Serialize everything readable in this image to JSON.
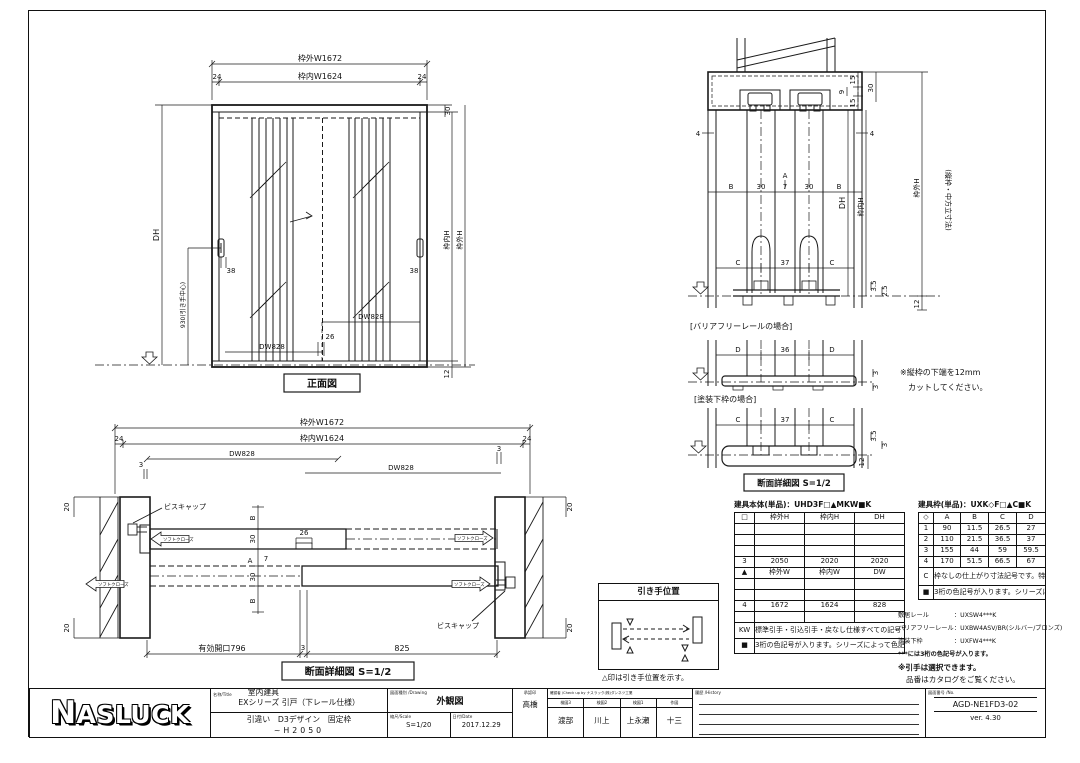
{
  "front_view": {
    "caption": "正面図",
    "w_out": "枠外W1672",
    "w_in": "枠内W1624",
    "m24l": "24",
    "m24r": "24",
    "m30": "30",
    "dh": "DH",
    "handle_center": "930(引き手中心)",
    "m38l": "38",
    "m38r": "38",
    "dw_l": "DW828",
    "dw_r": "DW828",
    "m26": "26",
    "h_in": "枠内H",
    "h_out": "枠外H",
    "m12": "12"
  },
  "plan_section": {
    "caption": "断面詳細図 S=1/2",
    "w_out": "枠外W1672",
    "w_in": "枠内W1624",
    "m24l": "24",
    "m24r": "24",
    "dw_l": "DW828",
    "dw_r": "DW828",
    "m3l": "3",
    "m3r": "3",
    "m20": "20",
    "screw_cap": "ビスキャップ",
    "soft_close": "ソフトクローズ",
    "mB": "B",
    "m30": "30",
    "m26": "26",
    "mA": "A",
    "m7": "7",
    "opening": "有効開口796",
    "m3c": "3",
    "m825": "825"
  },
  "vertical_section": {
    "m4l": "4",
    "m4r": "4",
    "mB1": "B",
    "m30a": "30",
    "m7": "7",
    "m30b": "30",
    "mB2": "B",
    "mA": "A",
    "m15a": "15",
    "m9": "9",
    "m15b": "15",
    "m30r": "30",
    "dh": "DH",
    "h_in": "枠内H",
    "h_out": "枠外H",
    "m12": "12",
    "v_note": "(縦枠・中方立寸法)",
    "rail1": {
      "c1": "C",
      "m37": "37",
      "c2": "C",
      "m35": "3.5",
      "m25": "2.5",
      "label": "[バリアフリーレールの場合]"
    },
    "rail2": {
      "d1": "D",
      "m36": "36",
      "d2": "D",
      "m3a": "3",
      "m3b": "3",
      "label": "[塗装下枠の場合]"
    },
    "rail3": {
      "c1": "C",
      "m37": "37",
      "c2": "C",
      "m35": "3.5",
      "m3": "3",
      "m12": "12",
      "caption": "断面詳細図 S=1/2"
    },
    "cut_note1": "※縦枠の下端を12mm",
    "cut_note2": "カットしてください。"
  },
  "handle_box": {
    "title": "引き手位置",
    "note": "△印は引き手位置を示す。"
  },
  "body_table": {
    "title": "建具本体(単品)：UHD3F□▲MKW■K",
    "h1": [
      "□",
      "枠外H",
      "枠内H",
      "DH"
    ],
    "row3": [
      "3",
      "2050",
      "2020",
      "2020"
    ],
    "h2": [
      "▲",
      "枠外W",
      "枠内W",
      "DW"
    ],
    "row4": [
      "4",
      "1672",
      "1624",
      "828"
    ],
    "kw_label": "KW",
    "kw_note": "標準引手・引込引手・戻なし仕様すべての記号です。特あり仕様設定はありません。引手Noによって記号は異なります。",
    "sq_label": "■",
    "sq_note": "3桁の色記号が入ります。シリーズによって色記号が設定されています。"
  },
  "frame_table": {
    "title": "建具枠(単品)：UXK◇F□▲C■K",
    "header": [
      "◇",
      "A",
      "B",
      "C",
      "D"
    ],
    "rows": [
      [
        "1",
        "90",
        "11.5",
        "26.5",
        "27"
      ],
      [
        "2",
        "110",
        "21.5",
        "36.5",
        "37"
      ],
      [
        "3",
        "155",
        "44",
        "59",
        "59.5"
      ],
      [
        "4",
        "170",
        "51.5",
        "66.5",
        "67"
      ]
    ],
    "c_label": "C",
    "c_note": "枠なしの仕上がり寸法記号です。特あり仕様設定はありません。敷居レール・バリアフリーレール・塗装下枠は選択されません。",
    "sq_label": "■",
    "sq_note": "3桁の色記号が入ります。シリーズによって色記号が設定されています。"
  },
  "rail_notes": {
    "sill_label": "敷居レール",
    "sill_value": "：UXSW4***K",
    "bf_label": "バリアフリーレール",
    "bf_value": "：UXBW4ASV/BR(シルバー/ブロンズ)",
    "paint_label": "塗装下枠",
    "paint_value": "：UXFW4***K",
    "color_note": "***には3桁の色記号が入ります。",
    "select_note": "※引手は選択できます。",
    "catalog_note": "品番はカタログをご覧ください。"
  },
  "title_block": {
    "logo": "NASLUCK",
    "name_header": "名称/Title",
    "name1": "室内建具",
    "name2": "EXシリーズ 引戸（下レール仕様）",
    "name3": "引違い　D3デザイン　固定枠",
    "name4": "~H2050",
    "drawing_header": "図面種別 /Drawing",
    "drawing_value": "外観図",
    "scale_header": "縮尺/Scale",
    "scale_value": "S=1/20",
    "date_header": "日付/Date",
    "date_value": "2017.12.29",
    "approval_header": "承認印",
    "approval_value": "高橋",
    "check_header": "確認者 /Check up by ナスラック(株)ダンネツ工業",
    "col1_header": "検図3",
    "col1_value": "渡部",
    "col2_header": "検図2",
    "col2_value": "川上",
    "col3_header": "検図1",
    "col3_value": "上永瀬",
    "col4_header": "作図",
    "col4_value": "十三",
    "history_header": "履歴 /History",
    "number_header": "図面番号 /No.",
    "number_value": "AGD-NE1FD3-02",
    "version": "ver. 4.30"
  }
}
